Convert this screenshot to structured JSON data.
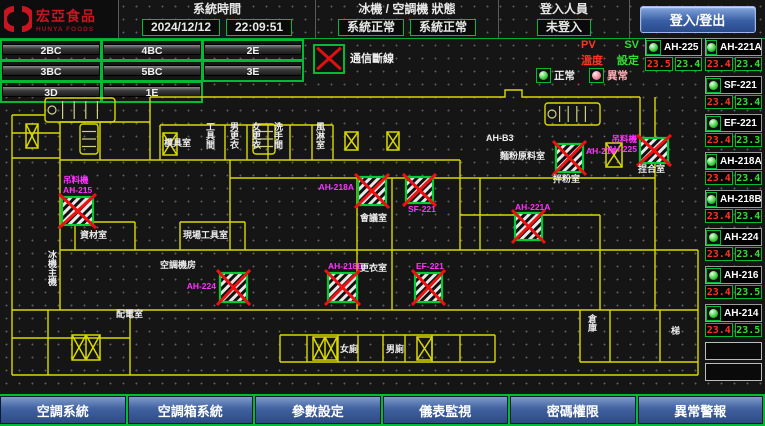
{
  "header": {
    "brand": "宏亞食品",
    "brand_sub": "HUNYA FOODS",
    "system_time": {
      "label": "系統時間",
      "date": "2024/12/12",
      "time": "22:09:51"
    },
    "machine_status": {
      "label": "冰機 / 空調機 狀態",
      "chiller": "系統正常",
      "ac": "系統正常"
    },
    "login": {
      "label": "登入人員",
      "status": "未登入",
      "button": "登入/登出"
    }
  },
  "floor_buttons": [
    [
      "2BC",
      "4BC",
      "2E"
    ],
    [
      "3BC",
      "5BC",
      "3E"
    ],
    [
      "3D",
      "1E"
    ]
  ],
  "legend": {
    "comm_loss": "通信斷線",
    "pv": "PV",
    "sv": "SV",
    "pv_desc": "溫度",
    "sv_desc": "設定",
    "normal": "正常",
    "abnormal": "異常"
  },
  "units": {
    "pair": [
      {
        "name": "AH-225",
        "pv": "23.5",
        "sv": "23.4"
      },
      {
        "name": "AH-221A",
        "pv": "23.4",
        "sv": "23.4"
      }
    ],
    "list": [
      {
        "name": "SF-221",
        "pv": "23.4",
        "sv": "23.4"
      },
      {
        "name": "EF-221",
        "pv": "23.4",
        "sv": "23.3"
      },
      {
        "name": "AH-218A",
        "pv": "23.4",
        "sv": "23.4"
      },
      {
        "name": "AH-218B",
        "pv": "23.4",
        "sv": "23.4"
      },
      {
        "name": "AH-224",
        "pv": "23.4",
        "sv": "23.4"
      },
      {
        "name": "AH-216",
        "pv": "23.4",
        "sv": "23.5"
      },
      {
        "name": "AH-214",
        "pv": "23.4",
        "sv": "23.5"
      }
    ],
    "empty_slots": 2
  },
  "floorplan": {
    "ahu_boxes": [
      {
        "x": 62,
        "y": 109,
        "w": 31,
        "h": 28,
        "lines": [
          "吊料機",
          "AH-215"
        ],
        "lx": 63,
        "ly": 95,
        "anchor": "start"
      },
      {
        "x": 358,
        "y": 89,
        "w": 28,
        "h": 28,
        "lines": [
          "AH-218A"
        ],
        "lx": 354,
        "ly": 102,
        "anchor": "end"
      },
      {
        "x": 406,
        "y": 89,
        "w": 27,
        "h": 26,
        "lines": [
          "SF-221"
        ],
        "lx": 408,
        "ly": 124,
        "anchor": "start"
      },
      {
        "x": 556,
        "y": 56,
        "w": 27,
        "h": 28,
        "lines": [
          "AH-214"
        ],
        "lx": 586,
        "ly": 66,
        "anchor": "start"
      },
      {
        "x": 640,
        "y": 50,
        "w": 28,
        "h": 25,
        "lines": [
          "吊料機",
          "AH-225"
        ],
        "lx": 637,
        "ly": 54,
        "anchor": "end"
      },
      {
        "x": 515,
        "y": 125,
        "w": 27,
        "h": 27,
        "lines": [
          "AH-221A"
        ],
        "lx": 515,
        "ly": 122,
        "anchor": "start"
      },
      {
        "x": 328,
        "y": 185,
        "w": 29,
        "h": 29,
        "lines": [
          "AH-218B"
        ],
        "lx": 328,
        "ly": 181,
        "anchor": "start"
      },
      {
        "x": 415,
        "y": 185,
        "w": 27,
        "h": 29,
        "lines": [
          "EF-221"
        ],
        "lx": 416,
        "ly": 181,
        "anchor": "start"
      },
      {
        "x": 220,
        "y": 185,
        "w": 27,
        "h": 29,
        "lines": [
          "AH-224"
        ],
        "lx": 216,
        "ly": 201,
        "anchor": "end"
      }
    ],
    "labels": [
      {
        "t": "工具間",
        "x": 206,
        "y": 42,
        "v": true
      },
      {
        "t": "模具室",
        "x": 164,
        "y": 58
      },
      {
        "t": "男更衣",
        "x": 230,
        "y": 42,
        "v": true
      },
      {
        "t": "女更衣",
        "x": 252,
        "y": 42,
        "v": true
      },
      {
        "t": "洗手間",
        "x": 274,
        "y": 42,
        "v": true
      },
      {
        "t": "風淋室",
        "x": 316,
        "y": 42,
        "v": true
      },
      {
        "t": "資材室",
        "x": 80,
        "y": 150
      },
      {
        "t": "現場工具室",
        "x": 183,
        "y": 150
      },
      {
        "t": "配電室",
        "x": 116,
        "y": 229
      },
      {
        "t": "冰機主機",
        "x": 48,
        "y": 170,
        "v": true
      },
      {
        "t": "空調機房",
        "x": 160,
        "y": 180
      },
      {
        "t": "會議室",
        "x": 360,
        "y": 133
      },
      {
        "t": "更衣室",
        "x": 360,
        "y": 183
      },
      {
        "t": "女廁",
        "x": 340,
        "y": 264
      },
      {
        "t": "男廁",
        "x": 386,
        "y": 264
      },
      {
        "t": "AH-B3",
        "x": 486,
        "y": 53
      },
      {
        "t": "麵粉原料室",
        "x": 500,
        "y": 71
      },
      {
        "t": "拌粉室",
        "x": 553,
        "y": 94
      },
      {
        "t": "捏合室",
        "x": 638,
        "y": 84
      },
      {
        "t": "倉庫",
        "x": 588,
        "y": 234,
        "v": true
      },
      {
        "t": "梯",
        "x": 671,
        "y": 246
      }
    ],
    "symbols": [
      {
        "type": "stairs",
        "x": 45,
        "y": 10,
        "w": 70,
        "h": 24
      },
      {
        "type": "stairs",
        "x": 545,
        "y": 15,
        "w": 55,
        "h": 22
      },
      {
        "type": "stairsv",
        "x": 80,
        "y": 36,
        "w": 18,
        "h": 30
      },
      {
        "type": "stairsv",
        "x": 253,
        "y": 36,
        "w": 22,
        "h": 30
      },
      {
        "type": "x",
        "x": 26,
        "y": 36,
        "w": 12,
        "h": 24
      },
      {
        "type": "x",
        "x": 163,
        "y": 45,
        "w": 14,
        "h": 22
      },
      {
        "type": "x",
        "x": 345,
        "y": 44,
        "w": 13,
        "h": 18
      },
      {
        "type": "x",
        "x": 387,
        "y": 44,
        "w": 12,
        "h": 18
      },
      {
        "type": "x",
        "x": 606,
        "y": 55,
        "w": 16,
        "h": 24
      },
      {
        "type": "x2",
        "x": 72,
        "y": 247,
        "w": 28,
        "h": 25
      },
      {
        "type": "x2",
        "x": 313,
        "y": 249,
        "w": 24,
        "h": 23
      },
      {
        "type": "x",
        "x": 417,
        "y": 249,
        "w": 15,
        "h": 23
      }
    ]
  },
  "bottom_nav": [
    "空調系統",
    "空調箱系統",
    "參數設定",
    "儀表監視",
    "密碼權限",
    "異常警報"
  ],
  "colors": {
    "wall": "#d9d900",
    "frame_green": "#00bb33",
    "pv_red": "#ff3322",
    "sv_green": "#33dd33",
    "magenta": "#ff33ff",
    "fault_x_red": "#ee1111",
    "brand_red": "#c81522",
    "button_blue": "#41619f"
  }
}
